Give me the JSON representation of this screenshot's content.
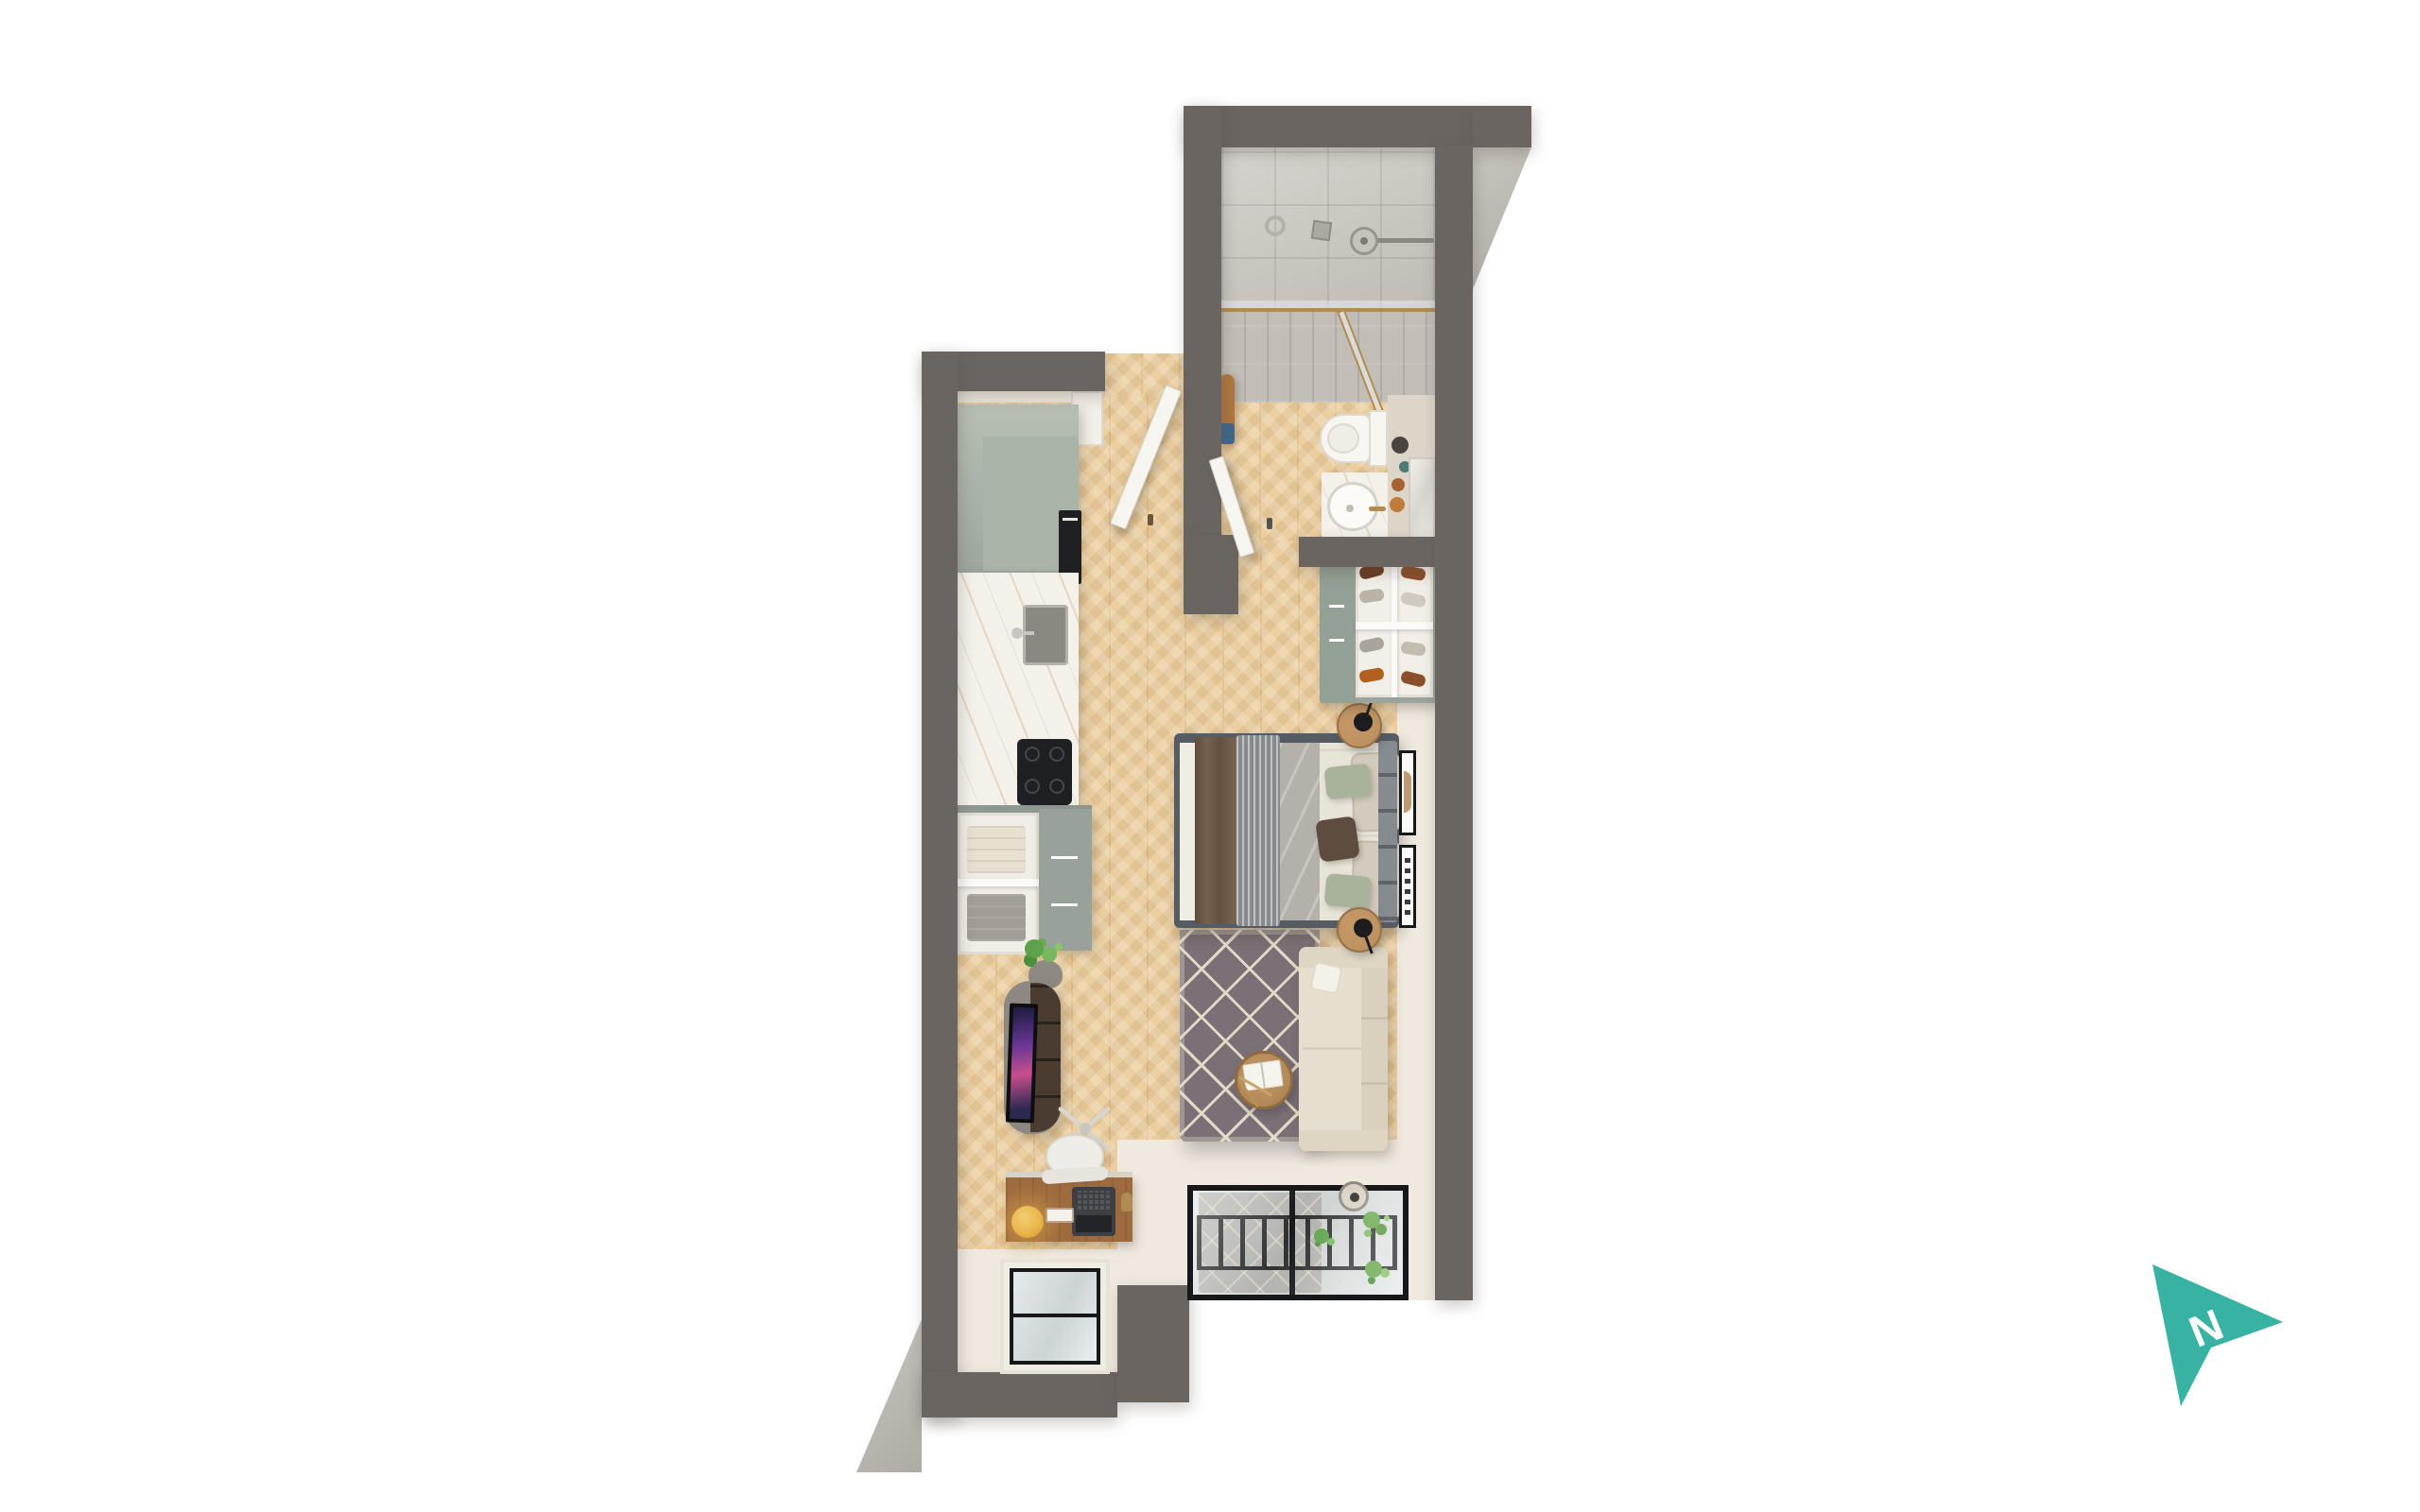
{
  "scene": {
    "description": "3D top-down rendered floor plan of a narrow studio apartment on a white background",
    "background": "#ffffff",
    "view": "top-down axonometric render"
  },
  "north_indicator": {
    "label": "N",
    "color": "#38b2a3"
  },
  "palette": {
    "wall": "#6b6562",
    "wall_face": "#c9c6bf",
    "inner_wall": "#efe9df",
    "floor": "#eccfa0",
    "tile": "#c9c5be",
    "counter": "#f4f1ea",
    "sage": "#9da79e",
    "sage_light": "#b7bfb4",
    "white_fixture": "#f8f6f1",
    "appliance_black": "#1f2023",
    "steel": "#8b8781",
    "rug": "#7a7075",
    "rug_line": "#e2dac6",
    "sofa": "#e6dfcf",
    "bed_frame": "#565c63",
    "duvet": "#e9e4d8",
    "sheet_grey": "#b4b1aa",
    "blanket_brown": "#6e5947",
    "runner_grey": "#87898d",
    "pillow_sage": "#a9b29a",
    "pillow_beige": "#d3ccbe",
    "pillow_brown": "#5f4c40",
    "headboard": "#7c8187",
    "wood_furniture": "#b98e5f",
    "console_wood": "#4a3c31",
    "concrete_top": "#8d8881",
    "desk_wood": "#9e6b3f",
    "glass": "#dde1e3",
    "frame_black": "#17181a",
    "gold_brass": "#b08b52",
    "plant_green": "#5fa24c",
    "lamp_yellow": "#e9b64a",
    "towel_tan": "#b0763f",
    "towel_blue": "#41678a",
    "tv_screen_purple": "#6a3797",
    "tv_screen_pink": "#c84f8c"
  },
  "rooms": [
    {
      "id": "bathroom",
      "features": [
        "walk-in-shower",
        "shower-head",
        "glass-screen",
        "toilet",
        "vanity-basin",
        "mirror",
        "towel-rail",
        "bathroom-door"
      ]
    },
    {
      "id": "entry-hall",
      "features": [
        "entry-door",
        "threshold"
      ]
    },
    {
      "id": "kitchen",
      "features": [
        "tall-cabinets",
        "built-in-oven",
        "sink",
        "cooktop",
        "marble-counter",
        "dresser-open-shelves",
        "folded-clothes"
      ]
    },
    {
      "id": "living-sleeping-area",
      "features": [
        "double-bed",
        "headboard",
        "nightstand",
        "nightstand",
        "wall-art",
        "wall-art",
        "shoe-wardrobe",
        "rug",
        "coffee-table",
        "open-book",
        "sofa",
        "tv-console",
        "tv",
        "desk",
        "desk-chair",
        "laptop",
        "desk-lamp",
        "plant"
      ]
    },
    {
      "id": "balcony",
      "features": [
        "glazed-sliding-doors",
        "juliet-railing",
        "plants",
        "pendant-planter",
        "side-window"
      ]
    }
  ]
}
